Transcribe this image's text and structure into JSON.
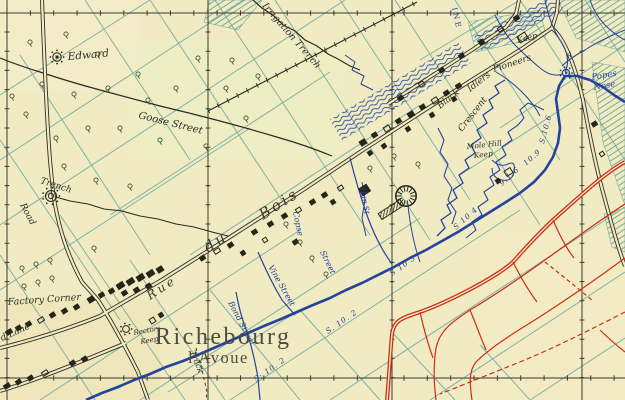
{
  "colors": {
    "paper": "#f1ebc4",
    "field_line_teal": "#6fa89a",
    "trench_blue": "#24439a",
    "enemy_red": "#cf2d18",
    "ink_black": "#2b2b20",
    "town_ink": "#4b4b3e"
  },
  "labels": {
    "edward": "Edward",
    "irrigation_trench": "Irrigation Trench",
    "goose_street": "Goose Street",
    "trench": "Trench",
    "road": "Road",
    "factory_corner": "Factory Corner",
    "d_lane": "d Lane",
    "rectors": "Rectors",
    "rectors_keep": "Keep",
    "richebourg": "Richebourg",
    "lavoue": "l'Avoue",
    "track": "Track",
    "rue": "Rue",
    "du": "du",
    "bois": "Bois",
    "bond_street": "Bond Street",
    "vine_street": "Vine Street",
    "copse": "Copse",
    "copse_street": "Street",
    "hun_st": "Hun St",
    "mole_hill": "Mole Hill",
    "mole_hill_keep": "Keep",
    "black": "Black",
    "idlers": "Idlers",
    "crescent": "Crescent",
    "pioneers": "Pioneers",
    "keep_north": "Keep",
    "popes": "Popes",
    "nose": "Nose",
    "road_ine": "INE",
    "a_marker": "A",
    "ref_s102_a": "S. 10. 2",
    "ref_s102_b": "S: 10. 2",
    "ref_s103": "S 10 3",
    "ref_s104": "S 10 4",
    "ref_s106": "S.10.6",
    "ref_916": "9.1.6",
    "ref_109": "10.9"
  }
}
